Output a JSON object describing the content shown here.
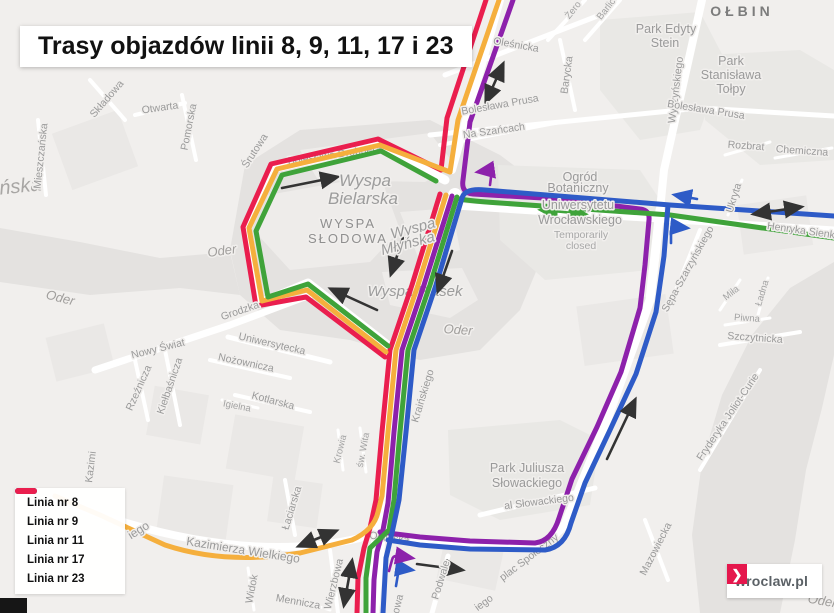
{
  "title": "Trasy objazdów linii 8, 9, 11, 17 i 23",
  "legend": {
    "items": [
      {
        "label": "Linia nr 8",
        "color": "#8d21ab"
      },
      {
        "label": "Linia nr 9",
        "color": "#3fa33a"
      },
      {
        "label": "Linia nr 11",
        "color": "#f5af3d"
      },
      {
        "label": "Linia nr 17",
        "color": "#2e5bc7"
      },
      {
        "label": "Linia nr 23",
        "color": "#ea1e4e"
      }
    ]
  },
  "logo": {
    "text": "wroclaw.pl",
    "chevron": "❯",
    "accent": "#e5174d"
  },
  "routes": {
    "purple": "#8d21ab",
    "green": "#3fa33a",
    "yellow": "#f5af3d",
    "blue": "#2e5bc7",
    "red": "#ea1e4e",
    "arrow": "#333333"
  },
  "map": {
    "labels": {
      "olbin": "OŁBIN",
      "park_edyty": [
        "Park Edyty",
        "Stein"
      ],
      "park_tolpy": [
        "Park",
        "Stanisława",
        "Tołpy"
      ],
      "park_slowackiego": [
        "Park Juliusza",
        "Słowackiego"
      ],
      "ogrod": [
        "Ogród",
        "Botaniczny",
        "Uniwersytetu",
        "Wrocławskiego"
      ],
      "closed": [
        "Temporarily",
        "closed"
      ],
      "bielarska": [
        "Wyspa",
        "Bielarska"
      ],
      "slodowa": [
        "WYSPA",
        "SŁODOWA"
      ],
      "mlynska": [
        "Wyspa",
        "Młyńska"
      ],
      "piasek": "Wyspa Piasek",
      "oder": "Oder",
      "wyszynskiego": "Wyszyńskiego",
      "prusa": "Bolesława Prusa",
      "na_szancach": "Na Szańcach",
      "olesnicka": "Oleśnicka",
      "zero": "Żero",
      "barlick": "Barlic",
      "barycka": "Barycka",
      "rozbrat": "Rozbrat",
      "chemiczna": "Chemiczna",
      "ukryta": "Ukryta",
      "henryka": "Henryka Sienkiewicza",
      "sepa": "Sępa-Szarzyńskiego",
      "mila": "Miła",
      "ladna": "Ładna",
      "piwna": "Piwna",
      "szczytnicka": "Szczytnicka",
      "mieszczanska": "Mieszczańska",
      "anska": "ańska",
      "skladowa": "Składowa",
      "otwarta": "Otwarta",
      "pomorska": "Pomorska",
      "srutowa": "Śrutowa",
      "drobnera": "Bolesława Drobnera",
      "grodzka": "Grodzka",
      "nowy_swiat": "Nowy Świat",
      "uniwersytecka": "Uniwersytecka",
      "nozownicza": "Nożownicza",
      "kotlarska": "Kotlarska",
      "igielna": "Igielna",
      "rzeznicza": "Rzeźnicza",
      "kielbasnicza": "Kiełbaśnicza",
      "kazimi": "Kazimi",
      "krowia": "Krowia",
      "sw_wita": "św. Wita",
      "laciarska": "Łaciarska",
      "kazimierza": "Kazimierza Wielkiego",
      "iego": "iego",
      "owa": "owa",
      "widok": "Widok",
      "mennicza": "Mennicza",
      "wierzbowa": "Wierzbowa",
      "podwale": "Podwale",
      "olawska": "Oławska",
      "al_slowackiego": "al Słowackiego",
      "plac_spoleczny": "plac Społeczny",
      "mazowiecka": "Mazowiecka",
      "joliot": "Fryderyka Joliot-Curie",
      "krainskiego": "Kraińskiego",
      "ej": "ej"
    }
  }
}
